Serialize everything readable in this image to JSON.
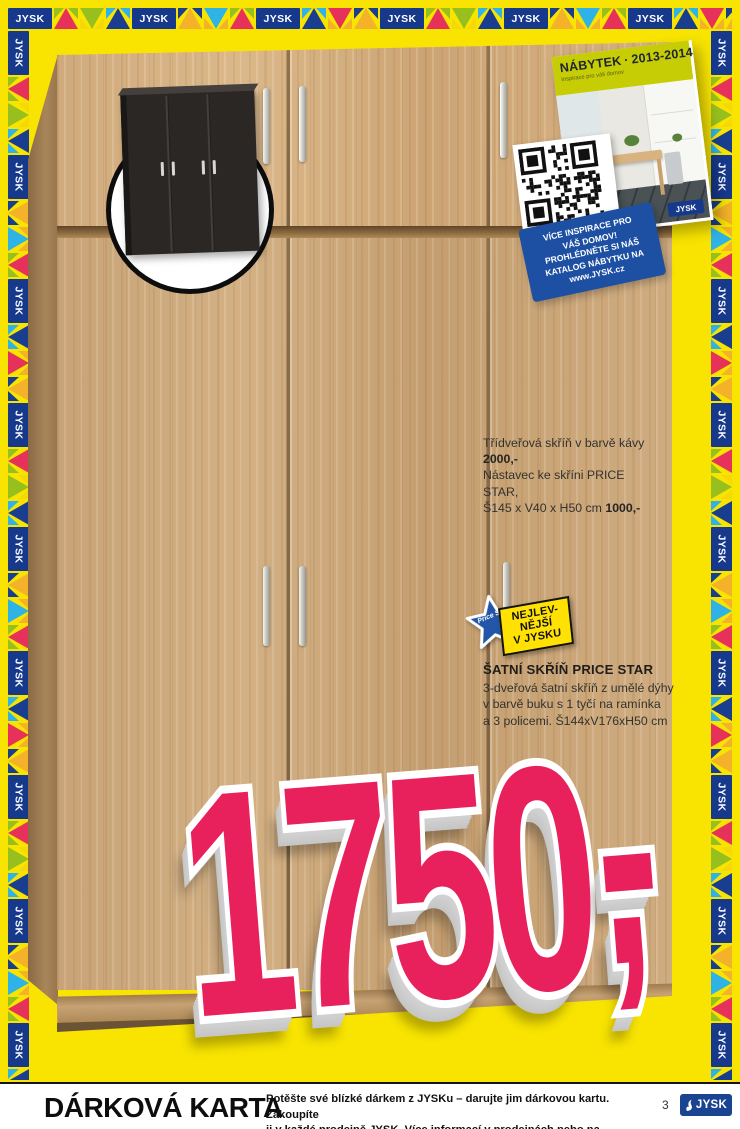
{
  "brand": "JYSK",
  "colors": {
    "page_yellow": "#F8E400",
    "jysk_blue": "#16398C",
    "price_pink": "#E8215C",
    "badge_yellow": "#FFE103",
    "wood_beech": "#C9A77C"
  },
  "border": {
    "logo_label": "JYSK"
  },
  "catalog_cover": {
    "title": "NÁBYTEK",
    "separator": "·",
    "years": "2013-2014",
    "subtitle": "Inspirace pro váš domov",
    "logo_label": "JYSK"
  },
  "qr_badge": {
    "lines": [
      "VÍCE INSPIRACE PRO",
      "VÁŠ DOMOV!",
      "PROHLÉDNĚTE SI NÁŠ",
      "KATALOG NÁBYTKU NA",
      "www.JYSK.cz"
    ]
  },
  "note": {
    "line1": "Třídveřová skříň v barvě kávy ",
    "line1_price": "2000,-",
    "line2": "Nástavec ke skříni PRICE STAR,",
    "line3": "Š145 x V40 x H50 cm ",
    "line3_price": "1000,-"
  },
  "price_star": {
    "star_label": "Price Star",
    "tag_lines": [
      "NEJLEV-",
      "NĚJŠÍ",
      "V JYSKU"
    ]
  },
  "product": {
    "title": "ŠATNÍ SKŘÍŇ PRICE STAR",
    "desc_lines": [
      "3-dveřová šatní skříň z umělé dýhy",
      "v barvě buku s 1 tyčí na ramínka",
      "a 3 policemi. Š144xV176xH50 cm"
    ]
  },
  "price": {
    "value": "1750",
    "dash": "-",
    "comma": ","
  },
  "footer": {
    "title": "DÁRKOVÁ KARTA",
    "line1": "Potěšte své blízké dárkem z JYSKu – darujte jim dárkovou kartu. Zakoupíte",
    "line2": "ji v každé prodejně JYSK. Více informací v prodejnách nebo na www.JYSK.cz.",
    "page_number": "3",
    "logo_label": "JYSK"
  }
}
